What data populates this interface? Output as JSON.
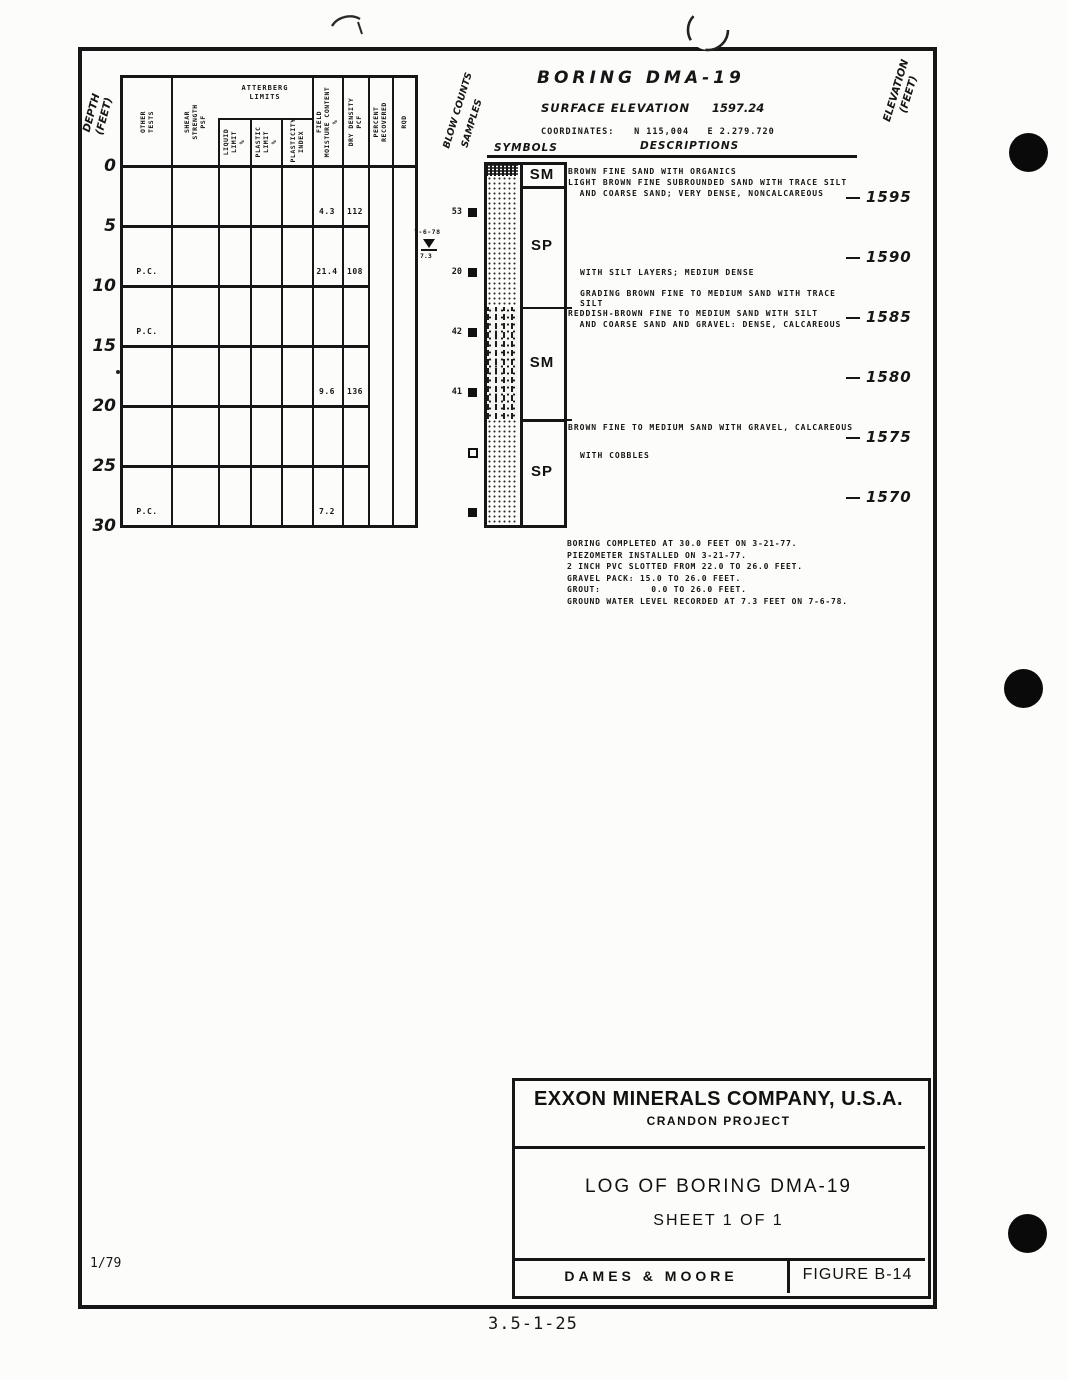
{
  "page": {
    "date_code": "1/79",
    "sheet_ref": "3.5-1-25"
  },
  "header": {
    "title": "BORING  DMA-19",
    "surface_elevation_label": "SURFACE ELEVATION",
    "surface_elevation_value": "1597.24",
    "coordinates_label": "COORDINATES:",
    "coordinates_value": "N 115,004   E 2.279.720"
  },
  "axis": {
    "depth_label": "DEPTH\n(FEET)",
    "blow_counts_label": "BLOW COUNTS",
    "samples_label": "SAMPLES",
    "symbols_label": "SYMBOLS",
    "descriptions_label": "DESCRIPTIONS",
    "elevation_label": "ELEVATION\n(FEET)"
  },
  "log_table": {
    "atterberg_group_label": "ATTERBERG\nLIMITS",
    "columns": [
      {
        "id": "other",
        "label": "OTHER\nTESTS"
      },
      {
        "id": "shear",
        "label": "SHEAR\nSTRENGTH\nPSF"
      },
      {
        "id": "liquid",
        "label": "LIQUID\nLIMIT\n%"
      },
      {
        "id": "plastic",
        "label": "PLASTIC\nLIMIT\n%"
      },
      {
        "id": "plasticity",
        "label": "PLASTICITY\nINDEX"
      },
      {
        "id": "moisture",
        "label": "FIELD\nMOISTURE CONTENT\n%"
      },
      {
        "id": "density",
        "label": "DRY DENSITY\nPCF"
      },
      {
        "id": "percent",
        "label": "PERCENT\nRECOVERED"
      },
      {
        "id": "rqd",
        "label": "RQD"
      }
    ],
    "depth_ticks": [
      0,
      5,
      10,
      15,
      20,
      25,
      30
    ],
    "values": [
      {
        "depth_ft": 4,
        "other_tests": "",
        "field_moisture": "4.3",
        "dry_density": "112"
      },
      {
        "depth_ft": 9,
        "other_tests": "P.C.",
        "field_moisture": "21.4",
        "dry_density": "108"
      },
      {
        "depth_ft": 14,
        "other_tests": "P.C.",
        "field_moisture": "",
        "dry_density": ""
      },
      {
        "depth_ft": 19,
        "other_tests": "",
        "field_moisture": "9.6",
        "dry_density": "136"
      },
      {
        "depth_ft": 29,
        "other_tests": "P.C.",
        "field_moisture": "7.2",
        "dry_density": ""
      }
    ]
  },
  "samples": [
    {
      "depth_ft": 4,
      "blow_count": "53",
      "marker": "filled"
    },
    {
      "depth_ft": 9,
      "blow_count": "20",
      "marker": "filled"
    },
    {
      "depth_ft": 14,
      "blow_count": "42",
      "marker": "filled"
    },
    {
      "depth_ft": 19,
      "blow_count": "41",
      "marker": "filled"
    },
    {
      "depth_ft": 24,
      "blow_count": "",
      "marker": "open"
    },
    {
      "depth_ft": 29,
      "blow_count": "",
      "marker": "filled"
    }
  ],
  "water_level": {
    "date": "7-6-78",
    "depth_ft": "7.3"
  },
  "strata": [
    {
      "symbol": "SM",
      "pattern": "organic",
      "top_ft": 0,
      "bottom_ft": 0.9
    },
    {
      "symbol": "SP",
      "pattern": "dots",
      "top_ft": 0.9,
      "bottom_ft": 11.8
    },
    {
      "symbol": "SM",
      "pattern": "silty",
      "top_ft": 11.8,
      "bottom_ft": 21.2
    },
    {
      "symbol": "SP",
      "pattern": "dots",
      "top_ft": 21.2,
      "bottom_ft": 30
    }
  ],
  "symbol_boxes": [
    {
      "label": "SM",
      "top_ft": -0.2,
      "bottom_ft": 1.75
    },
    {
      "label": "SP",
      "top_ft": 1.75,
      "bottom_ft": 11.8
    },
    {
      "label": "SM",
      "top_ft": 11.8,
      "bottom_ft": 21.2
    },
    {
      "label": "SP",
      "top_ft": 21.2,
      "bottom_ft": 30
    }
  ],
  "descriptions": [
    {
      "depth_ft": 0.2,
      "indent": 0,
      "text": "BROWN FINE SAND WITH ORGANICS"
    },
    {
      "depth_ft": 1.1,
      "indent": 0,
      "text": "LIGHT BROWN FINE SUBROUNDED SAND WITH TRACE SILT\n  AND COARSE SAND; VERY DENSE, NONCALCAREOUS"
    },
    {
      "depth_ft": 8.6,
      "indent": 1,
      "text": "WITH SILT LAYERS; MEDIUM DENSE"
    },
    {
      "depth_ft": 10.3,
      "indent": 1,
      "text": "GRADING BROWN FINE TO MEDIUM SAND WITH TRACE\nSILT"
    },
    {
      "depth_ft": 12.0,
      "indent": 0,
      "text": "REDDISH-BROWN FINE TO MEDIUM SAND WITH SILT\n  AND COARSE SAND AND GRAVEL: DENSE, CALCAREOUS"
    },
    {
      "depth_ft": 21.5,
      "indent": 0,
      "text": "BROWN FINE TO MEDIUM SAND WITH GRAVEL, CALCAREOUS"
    },
    {
      "depth_ft": 23.8,
      "indent": 1,
      "text": "WITH COBBLES"
    }
  ],
  "elevation_marks": [
    "1595",
    "1590",
    "1585",
    "1580",
    "1575",
    "1570"
  ],
  "notes": [
    "BORING COMPLETED AT 30.0 FEET ON 3-21-77.",
    "PIEZOMETER INSTALLED ON 3-21-77.",
    "2 INCH PVC SLOTTED FROM 22.0 TO 26.0 FEET.",
    "GRAVEL PACK: 15.0 TO 26.0 FEET.",
    "GROUT:         0.0 TO 26.0 FEET.",
    "GROUND WATER LEVEL RECORDED AT 7.3 FEET ON 7-6-78."
  ],
  "title_block": {
    "company": "EXXON MINERALS COMPANY, U.S.A.",
    "project": "CRANDON PROJECT",
    "log_title": "LOG OF BORING  DMA-19",
    "sheet": "SHEET 1 OF 1",
    "firm": "DAMES & MOORE",
    "figure": "FIGURE  B-14"
  }
}
